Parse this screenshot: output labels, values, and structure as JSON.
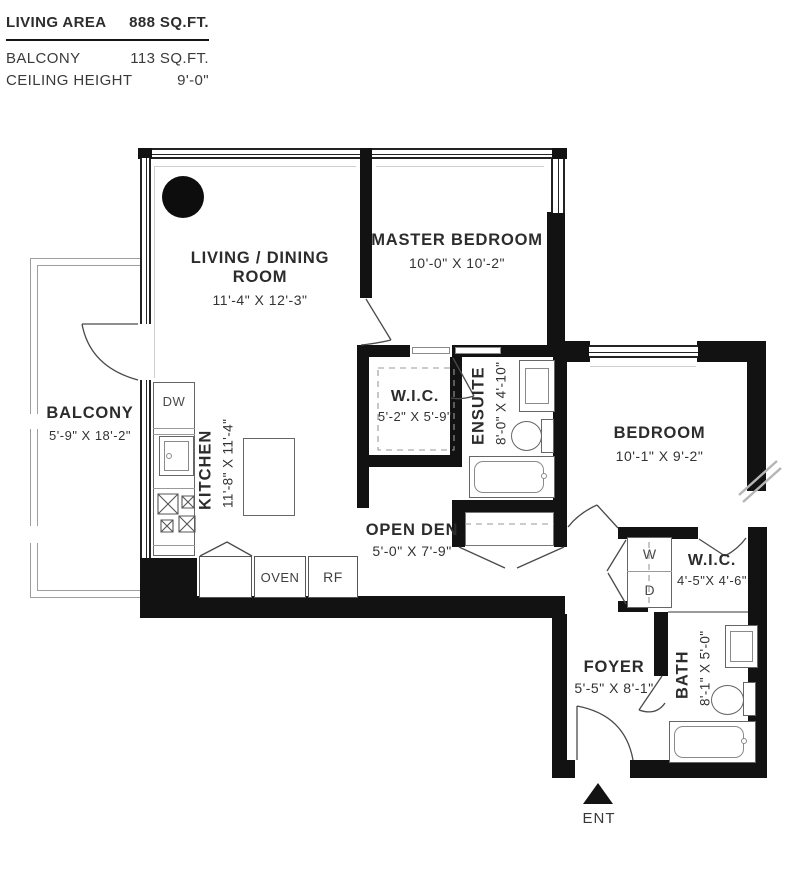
{
  "header": {
    "rows": [
      {
        "label": "LIVING AREA",
        "value": "888 SQ.FT."
      },
      {
        "label": "BALCONY",
        "value": "113 SQ.FT."
      },
      {
        "label": "CEILING HEIGHT",
        "value": "9'-0\""
      }
    ]
  },
  "rooms": {
    "living": {
      "line1": "LIVING / DINING",
      "line2": "ROOM",
      "dims": "11'-4\" X 12'-3\""
    },
    "master": {
      "name": "MASTER BEDROOM",
      "dims": "10'-0\" X 10'-2\""
    },
    "wic_master": {
      "name": "W.I.C.",
      "dims": "5'-2\" X 5'-9\""
    },
    "ensuite": {
      "name": "ENSUITE",
      "dims": "8'-0\" X 4'-10\""
    },
    "bedroom": {
      "name": "BEDROOM",
      "dims": "10'-1\" X 9'-2\""
    },
    "kitchen": {
      "name": "KITCHEN",
      "dims": "11'-8\" X 11'-4\""
    },
    "balcony": {
      "name": "BALCONY",
      "dims": "5'-9\" X 18'-2\""
    },
    "den": {
      "name": "OPEN DEN",
      "dims": "5'-0\" X 7'-9\""
    },
    "wic_bedroom": {
      "name": "W.I.C.",
      "dims": "4'-5\"X 4'-6\""
    },
    "foyer": {
      "name": "FOYER",
      "dims": "5'-5\" X 8'-1\""
    },
    "bath": {
      "name": "BATH",
      "dims": "8'-1\" X 5'-0\""
    }
  },
  "appliances": {
    "dishwasher": "DW",
    "oven": "OVEN",
    "fridge": "RF",
    "washer": "W",
    "dryer": "D"
  },
  "entry": {
    "label": "ENT"
  },
  "colors": {
    "wall": "#121212",
    "linework": "#4a4a4a",
    "text": "#2c2c2c",
    "background": "#ffffff"
  }
}
